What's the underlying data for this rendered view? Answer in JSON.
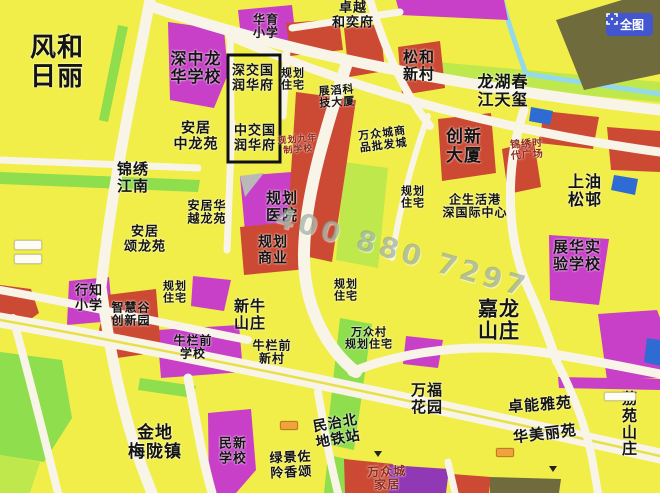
{
  "app": {
    "fullmap_button": {
      "label": "全图",
      "icon": "fullscreen-frame-icon",
      "bg_color": "#4257cf",
      "text_color": "#ffffff"
    }
  },
  "watermark": {
    "text": "400 880 7297"
  },
  "colors": {
    "base": "#f1ee49",
    "magenta": "#c83fc8",
    "red": "#cc4a34",
    "olive": "#6f6b3c",
    "purple": "#9138b4",
    "blue": "#2e6cd4",
    "green": "#8ede4e",
    "light_green": "#bfe84d",
    "river": "#92d9ec",
    "road": "#f8f4e8",
    "road_median": "#e6e049",
    "gray": "#b9b9b9",
    "dark_red_text": "#8f2a1c"
  },
  "map": {
    "labels": [
      {
        "name": "fenghe-rili",
        "text": "风和\n日丽"
      },
      {
        "name": "shenzhong-longhua-school",
        "text": "深中龙\n华学校"
      },
      {
        "name": "huayu-primary-school",
        "text": "华育\n小学"
      },
      {
        "name": "zhuoyue-heyifu",
        "text": "卓越\n和奕府"
      },
      {
        "name": "songhe-new-village",
        "text": "松和\n新村"
      },
      {
        "name": "longhu-chunjiang-tianxi",
        "text": "龙湖春\n江天玺"
      },
      {
        "name": "shenjiaoguo-runhuafu",
        "text": "深交国\n润华府"
      },
      {
        "name": "planned-residential-a",
        "text": "规划\n住宅"
      },
      {
        "name": "zhantao-tech-tower",
        "text": "展滔科\n技大厦"
      },
      {
        "name": "anju-zhonglongyuan",
        "text": "安居\n中龙苑"
      },
      {
        "name": "zhongjiaoguo-runhuafu",
        "text": "中交国\n润华府"
      },
      {
        "name": "planned-nine-year-school",
        "text": "规划九年\n制学校"
      },
      {
        "name": "wanzhongcheng-wholesale-city",
        "text": "万众城商\n品批发城"
      },
      {
        "name": "chuangxin-tower",
        "text": "创新\n大厦"
      },
      {
        "name": "jinxiu-times-plaza",
        "text": "锦绣时\n代广场"
      },
      {
        "name": "jinxiu-jiangnan",
        "text": "锦绣\n江南"
      },
      {
        "name": "shangyousong-village",
        "text": "上油\n松邨"
      },
      {
        "name": "anju-huayue-longyuan",
        "text": "安居华\n越龙苑"
      },
      {
        "name": "planned-hospital",
        "text": "规划\n医院"
      },
      {
        "name": "planned-residential-b",
        "text": "规划\n住宅"
      },
      {
        "name": "qishenghuogang-shen-intl-center",
        "text": "企生活港\n深国际中心"
      },
      {
        "name": "anju-songlongyuan",
        "text": "安居\n颂龙苑"
      },
      {
        "name": "planned-commercial",
        "text": "规划\n商业"
      },
      {
        "name": "zhanhua-experimental-school",
        "text": "展华实\n验学校"
      },
      {
        "name": "xingzhi-primary-school",
        "text": "行知\n小学"
      },
      {
        "name": "zhihuigu-innovation-park",
        "text": "智慧谷\n创新园"
      },
      {
        "name": "planned-residential-c",
        "text": "规划\n住宅"
      },
      {
        "name": "xinniu-shanzhuang",
        "text": "新牛\n山庄"
      },
      {
        "name": "planned-residential-d",
        "text": "规划\n住宅"
      },
      {
        "name": "niulanqian-school",
        "text": "牛栏前\n学校"
      },
      {
        "name": "niulanqian-new-village",
        "text": "牛栏前\n新村"
      },
      {
        "name": "wanzhong-village-planned-residential",
        "text": "万众村\n规划住宅"
      },
      {
        "name": "jialong-shanzhuang",
        "text": "嘉龙\n山庄"
      },
      {
        "name": "wanfu-garden",
        "text": "万福\n花园"
      },
      {
        "name": "jindi-meilongzhen",
        "text": "金地\n梅陇镇"
      },
      {
        "name": "minxin-school",
        "text": "民新\n学校"
      },
      {
        "name": "minzhibei-metro-station",
        "text": "民治北\n地铁站"
      },
      {
        "name": "lvjing-zuolin-xiangsong",
        "text": "绿景佐\n阾香颂"
      },
      {
        "name": "wanzhongcheng-home-furnishing",
        "text": "万众城\n家居"
      },
      {
        "name": "zhuoneng-yayuan",
        "text": "卓能雅苑"
      },
      {
        "name": "huameili-yuan",
        "text": "华美丽苑"
      },
      {
        "name": "liyuan-shanzhuang",
        "text": "荔苑\n山庄"
      }
    ]
  }
}
